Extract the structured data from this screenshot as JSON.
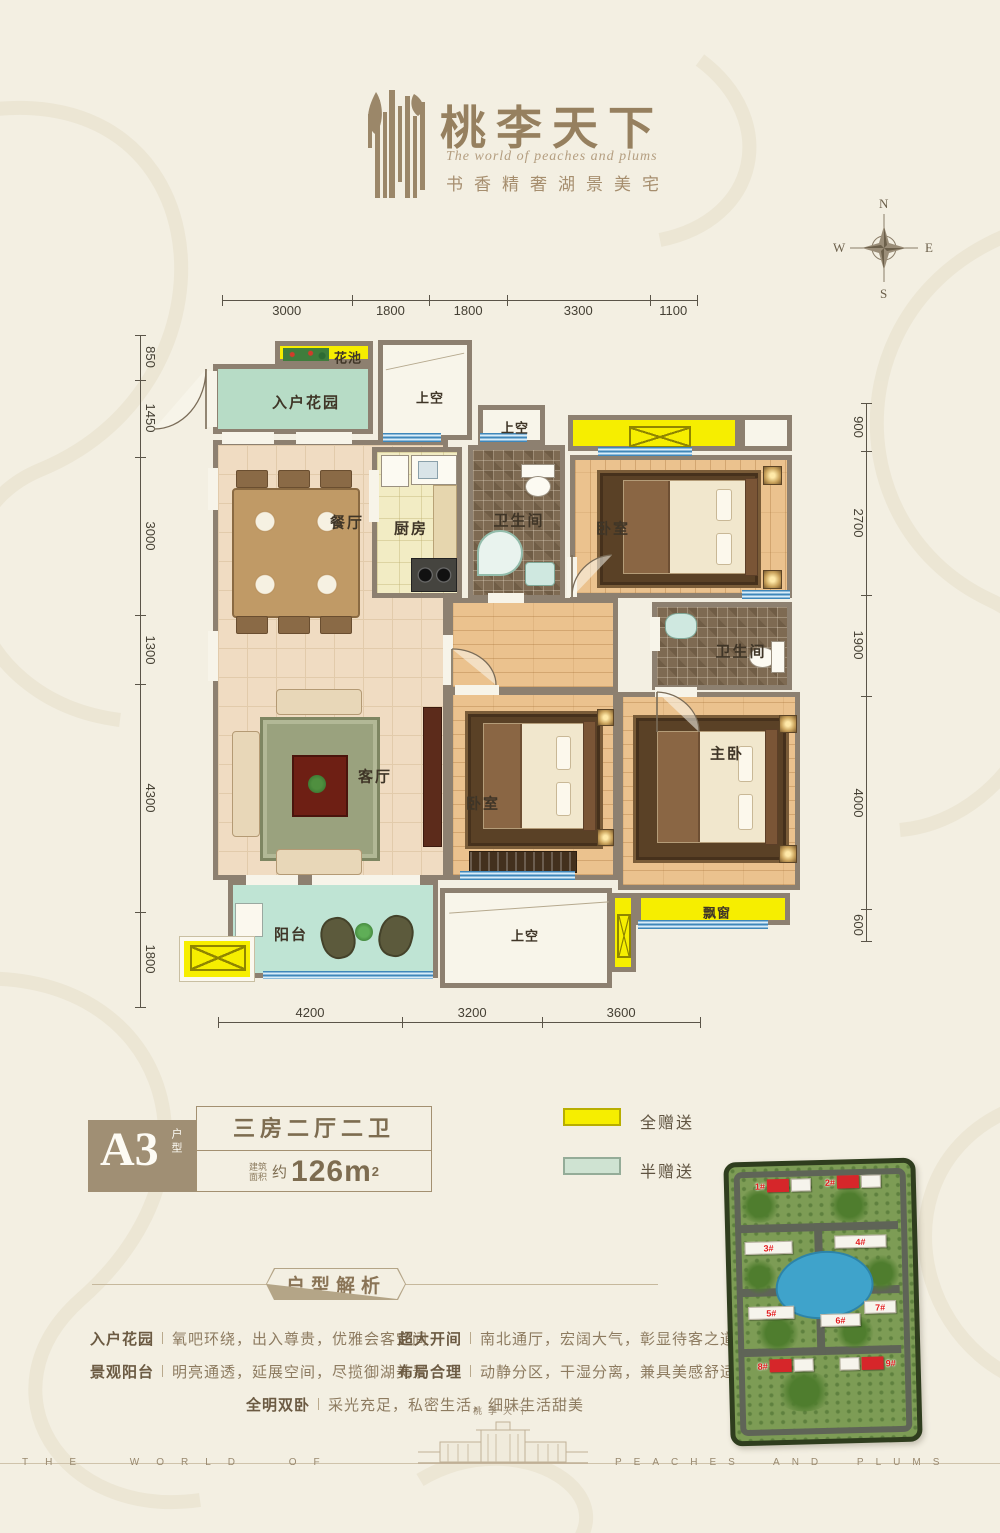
{
  "header": {
    "title": "桃李天下",
    "subtitle_en": "The world of peaches and plums",
    "tagline": "书香精奢湖景美宅"
  },
  "compass": {
    "n": "N",
    "e": "E",
    "s": "S",
    "w": "W"
  },
  "dimensions": {
    "top": [
      "3000",
      "1800",
      "1800",
      "3300",
      "1100"
    ],
    "bottom": [
      "4200",
      "3200",
      "3600"
    ],
    "left": [
      "850",
      "1450",
      "3000",
      "1300",
      "4300",
      "1800"
    ],
    "right": [
      "900",
      "2700",
      "1900",
      "4000",
      "600"
    ]
  },
  "plan": {
    "rooms": {
      "flower_bed": "花池",
      "entry_garden": "入户花园",
      "void_top": "上空",
      "void_small": "上空",
      "dining": "餐厅",
      "kitchen": "厨房",
      "bath1": "卫生间",
      "bedroom_top": "卧室",
      "bath2": "卫生间",
      "living": "客厅",
      "bedroom2": "卧室",
      "master": "主卧",
      "balcony": "阳台",
      "void_bottom": "上空",
      "bay_window": "飘窗"
    }
  },
  "unit": {
    "code": "A3",
    "code_suffix": "户型",
    "layout": "三房二厅二卫",
    "area_name_top": "建筑",
    "area_name_bottom": "面积",
    "area_approx": "约",
    "area_value": "126m",
    "area_sup": "2"
  },
  "legend": [
    {
      "label": "全赠送",
      "color": "#f6ee00",
      "border": "#b8ae00"
    },
    {
      "label": "半赠送",
      "color": "#cfe3d2",
      "border": "#94ac98"
    }
  ],
  "analysis": {
    "title": "户型解析",
    "lines": [
      {
        "label": "入户花园",
        "text": "氧吧环绕，出入尊贵，优雅会客空间"
      },
      {
        "label": "超大开间",
        "text": "南北通厅，宏阔大气，彰显待客之道"
      },
      {
        "label": "景观阳台",
        "text": "明亮通透，延展空间，尽揽御湖美景"
      },
      {
        "label": "布局合理",
        "text": "动静分区，干湿分离，兼具美感舒适"
      },
      {
        "label": "全明双卧",
        "text": "采光充足，私密生活，细味生活甜美"
      }
    ]
  },
  "siteplan": {
    "buildings": [
      "1#",
      "2#",
      "3#",
      "4#",
      "5#",
      "6#",
      "7#",
      "8#",
      "9#"
    ]
  },
  "footer": {
    "left": "THE WORLD OF",
    "right": "PEACHES AND PLUMS",
    "gate_title": "桃李天下"
  }
}
